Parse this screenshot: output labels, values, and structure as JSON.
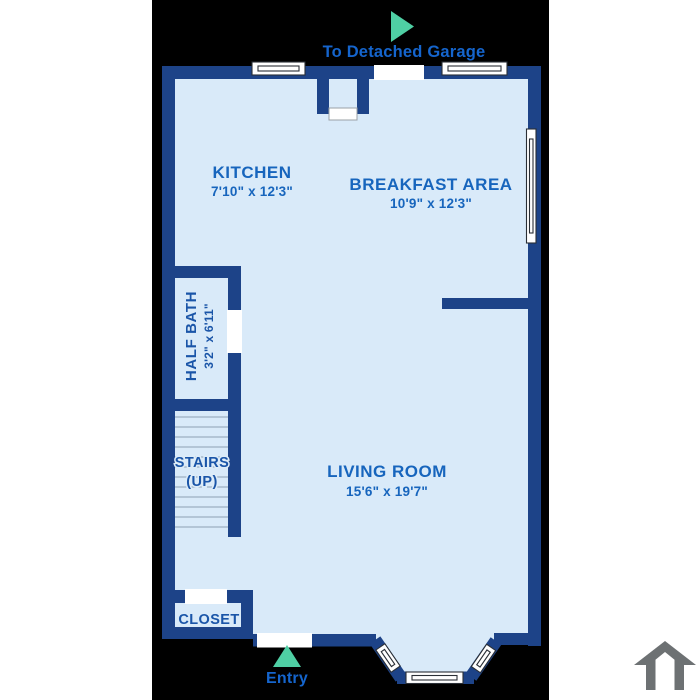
{
  "plan": {
    "rooms": {
      "kitchen": {
        "label": "KITCHEN",
        "dims": "7'10\" x 12'3\""
      },
      "breakfast": {
        "label": "BREAKFAST AREA",
        "dims": "10'9\" x 12'3\""
      },
      "half_bath": {
        "label": "HALF BATH",
        "dims": "3'2\" x 6'11\""
      },
      "stairs": {
        "label": "STAIRS",
        "sub": "(UP)"
      },
      "living": {
        "label": "LIVING ROOM",
        "dims": "15'6\" x 19'7\""
      },
      "closet": {
        "label": "CLOSET"
      }
    },
    "annotations": {
      "garage_label": "To Detached Garage",
      "entry_label": "Entry"
    },
    "icons": {
      "garage_arrow": "arrow-right-teal",
      "entry_arrow": "arrow-up-teal",
      "house": "house-outline-gray"
    },
    "colors": {
      "background": "#000000",
      "margin": "#ffffff",
      "wall": "#1d4388",
      "floor": "#d9eaf9",
      "room_label_blue": "#1765bd",
      "wayfinding_blue": "#1565cd",
      "arrow_teal": "#4fcfa4",
      "house_icon_gray": "#6d7173",
      "stair_tread": "#8da0b2"
    }
  }
}
